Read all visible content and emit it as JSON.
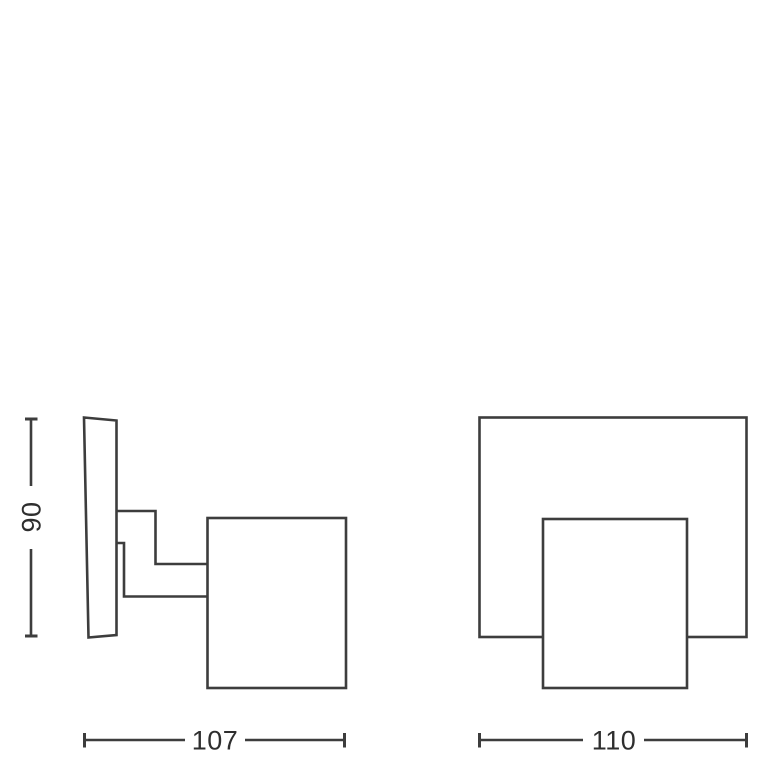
{
  "drawing": {
    "background": "#ffffff",
    "line_color": "#3d3d3d",
    "text_color": "#2e2e2e",
    "dimensions": {
      "height": {
        "label": "90",
        "orientation": "vertical"
      },
      "side_width": {
        "label": "107",
        "orientation": "horizontal"
      },
      "front_width": {
        "label": "110",
        "orientation": "horizontal"
      }
    }
  }
}
